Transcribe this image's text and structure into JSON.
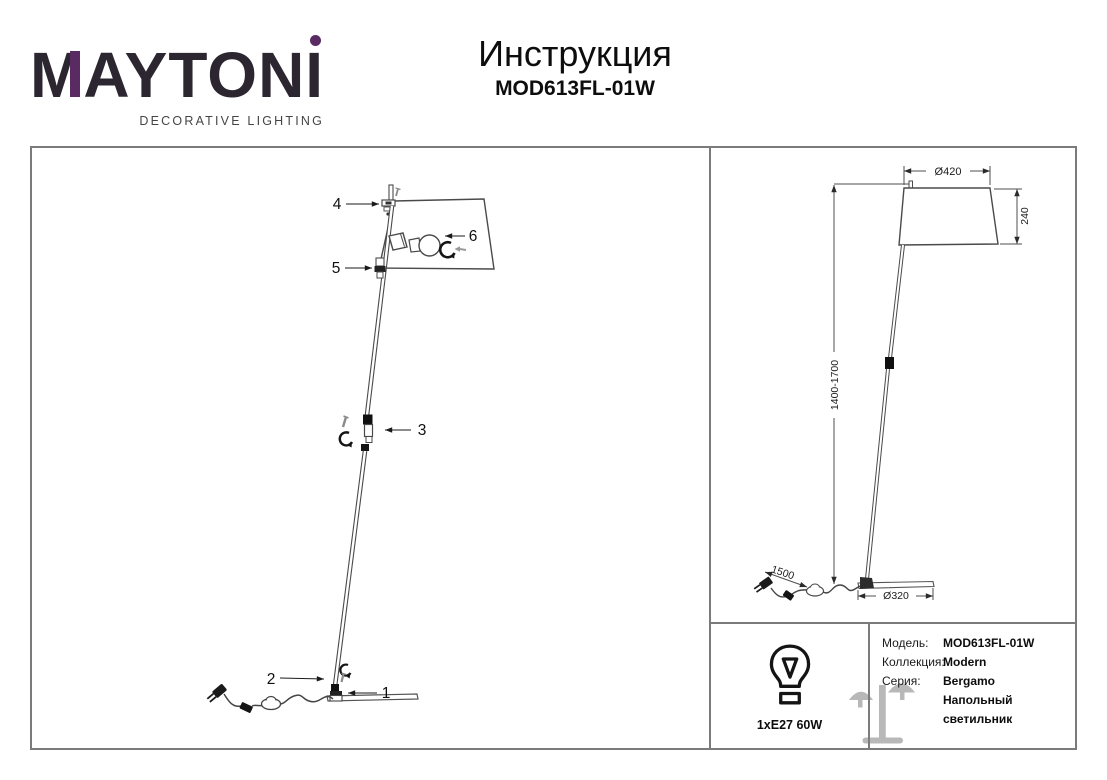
{
  "header": {
    "logo": {
      "m": "M",
      "rest": "AYTON",
      "i": "I",
      "tagline": "DECORATIVE LIGHTING",
      "accent_purple": "#5a2b63",
      "logo_dark": "#2b2630"
    },
    "title": "Инструкция",
    "model": "MOD613FL-01W"
  },
  "assembly": {
    "part_labels": [
      "1",
      "2",
      "3",
      "4",
      "5",
      "6"
    ]
  },
  "dimensions": {
    "shade_diameter": "Ø420",
    "shade_height": "240",
    "height_range": "1400-1700",
    "cord_length": "1500",
    "base_diameter": "Ø320"
  },
  "spec": {
    "bulb_label": "1xE27 60W",
    "rows": [
      {
        "label": "Модель:",
        "value": "MOD613FL-01W"
      },
      {
        "label": "Коллекция:",
        "value": "Modern"
      },
      {
        "label": "Серия:",
        "value": "Bergamo"
      }
    ],
    "lamp_type": "Напольный светильник"
  }
}
